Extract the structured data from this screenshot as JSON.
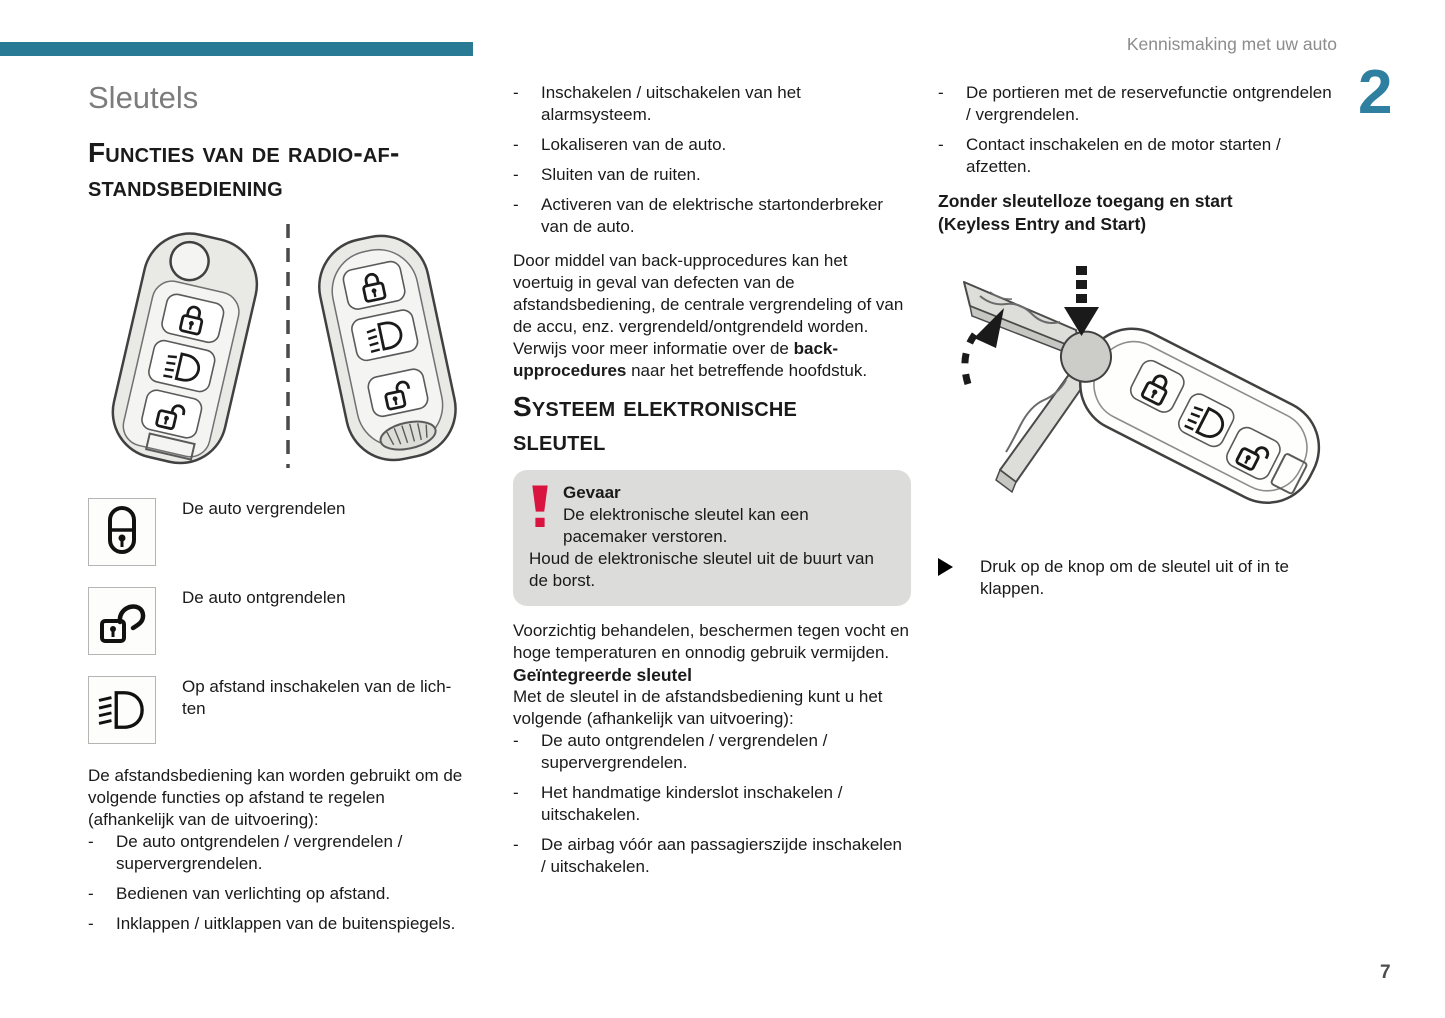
{
  "page": {
    "header_title": "Kennismaking met uw auto",
    "chapter_number": "2",
    "page_number": "7",
    "accent_color": "#287a95",
    "danger_color": "#d9143f",
    "warning_bg": "#dcdcda"
  },
  "marks": {
    "dash": "-"
  },
  "left": {
    "title": "Sleutels",
    "section_heading": "Functies van de radio-af-\nstandsbediening",
    "functions": [
      {
        "icon": "lock-closed-icon",
        "label": "De auto vergrendelen"
      },
      {
        "icon": "lock-open-icon",
        "label": "De auto ontgrendelen"
      },
      {
        "icon": "headlight-beams-icon",
        "label": "Op afstand inschakelen van de lich-\nten"
      }
    ],
    "intro": "De afstandsbediening kan worden gebruikt om de volgende functies op afstand te regelen (afhankelijk van de uitvoering):",
    "bullets": [
      "De auto ontgrendelen / vergrendelen / supervergrendelen.",
      "Bedienen van verlichting op afstand.",
      "Inklappen / uitklappen van de buitenspiegels."
    ]
  },
  "mid": {
    "bullets": [
      "Inschakelen / uitschakelen van het alarmsysteem.",
      "Lokaliseren van de auto.",
      "Sluiten van de ruiten.",
      "Activeren van de elektrische startonderbreker van de auto."
    ],
    "backup_paragraph": {
      "pre": "Door middel van back-upprocedures kan het voertuig in geval van defecten van de afstandsbediening, de centrale vergrendeling of van de accu, enz. vergrendeld/ontgrendeld worden. Verwijs voor meer informatie over de ",
      "bold": "back-upprocedures",
      "post": " naar het betreffende hoofdstuk."
    },
    "section_heading": "Systeem elektronische\nsleutel",
    "warning": {
      "title": "Gevaar",
      "line1": "De elektronische sleutel kan een pacemaker verstoren.",
      "line2": "Houd de elektronische sleutel uit de buurt van de borst."
    },
    "care_paragraph": "Voorzichtig behandelen, beschermen tegen vocht en hoge temperaturen en onnodig gebruik vermijden.",
    "integrated_heading": "Geïntegreerde sleutel",
    "integrated_intro": "Met de sleutel in de afstandsbediening kunt u het volgende (afhankelijk van uitvoering):",
    "integrated_bullets": [
      "De auto ontgrendelen / vergrendelen / supervergrendelen.",
      "Het handmatige kinderslot inschakelen / uitschakelen.",
      "De airbag vóór aan passagierszijde inschakelen / uitschakelen."
    ]
  },
  "right": {
    "bullets": [
      "De portieren met de reservefunctie ontgrendelen / vergrendelen.",
      "Contact inschakelen en de motor starten / afzetten."
    ],
    "keyless_heading": "Zonder sleutelloze toegang en start\n(Keyless Entry and Start)",
    "instruction": "Druk op de knop om de sleutel uit of in te klappen."
  }
}
